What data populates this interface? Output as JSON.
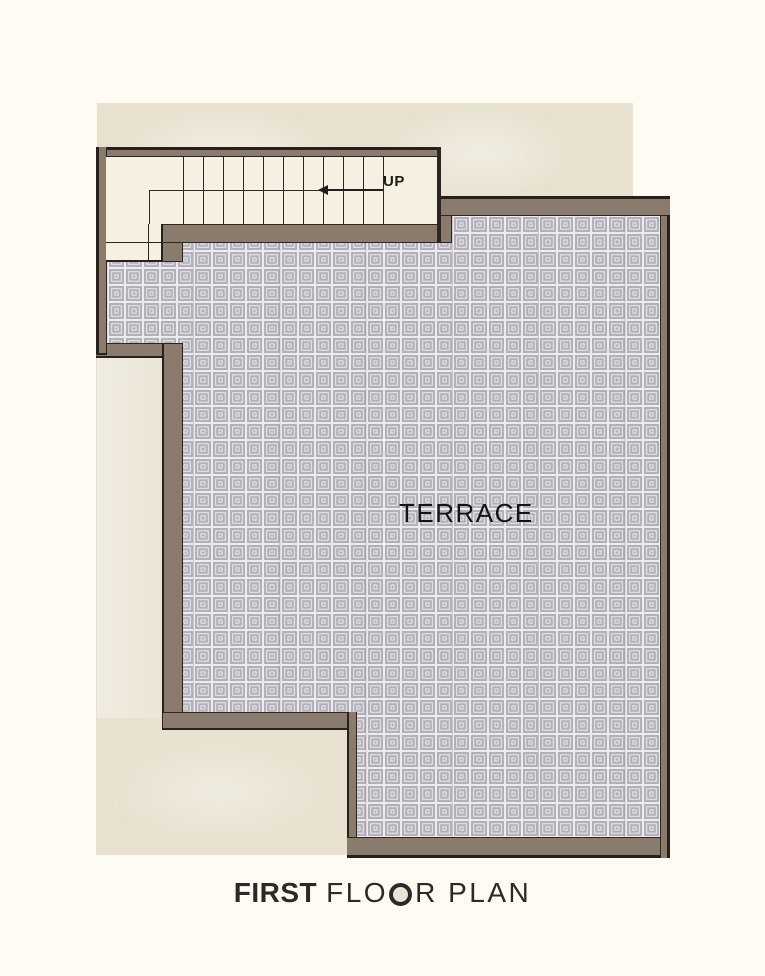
{
  "plan": {
    "stairs": {
      "up_label": "UP",
      "tread_count": 10,
      "arrow_direction": "left"
    },
    "terrace": {
      "label": "TERRACE"
    }
  },
  "title": {
    "word1": "FIRST",
    "word2_pre": "FLO",
    "word2_o": "O",
    "word2_post": "R",
    "word3": "PLAN"
  },
  "colors": {
    "background": "#fdfbf2",
    "paper": "#e8e1cf",
    "wall": "#8a7b6c",
    "outline": "#26211c",
    "stair_floor": "#f5f0df",
    "tile_gray": "#b2b0b8",
    "tile_line": "#edebef",
    "text": "#141414"
  },
  "tile_grid": {
    "columns": 32,
    "rows": 36
  }
}
